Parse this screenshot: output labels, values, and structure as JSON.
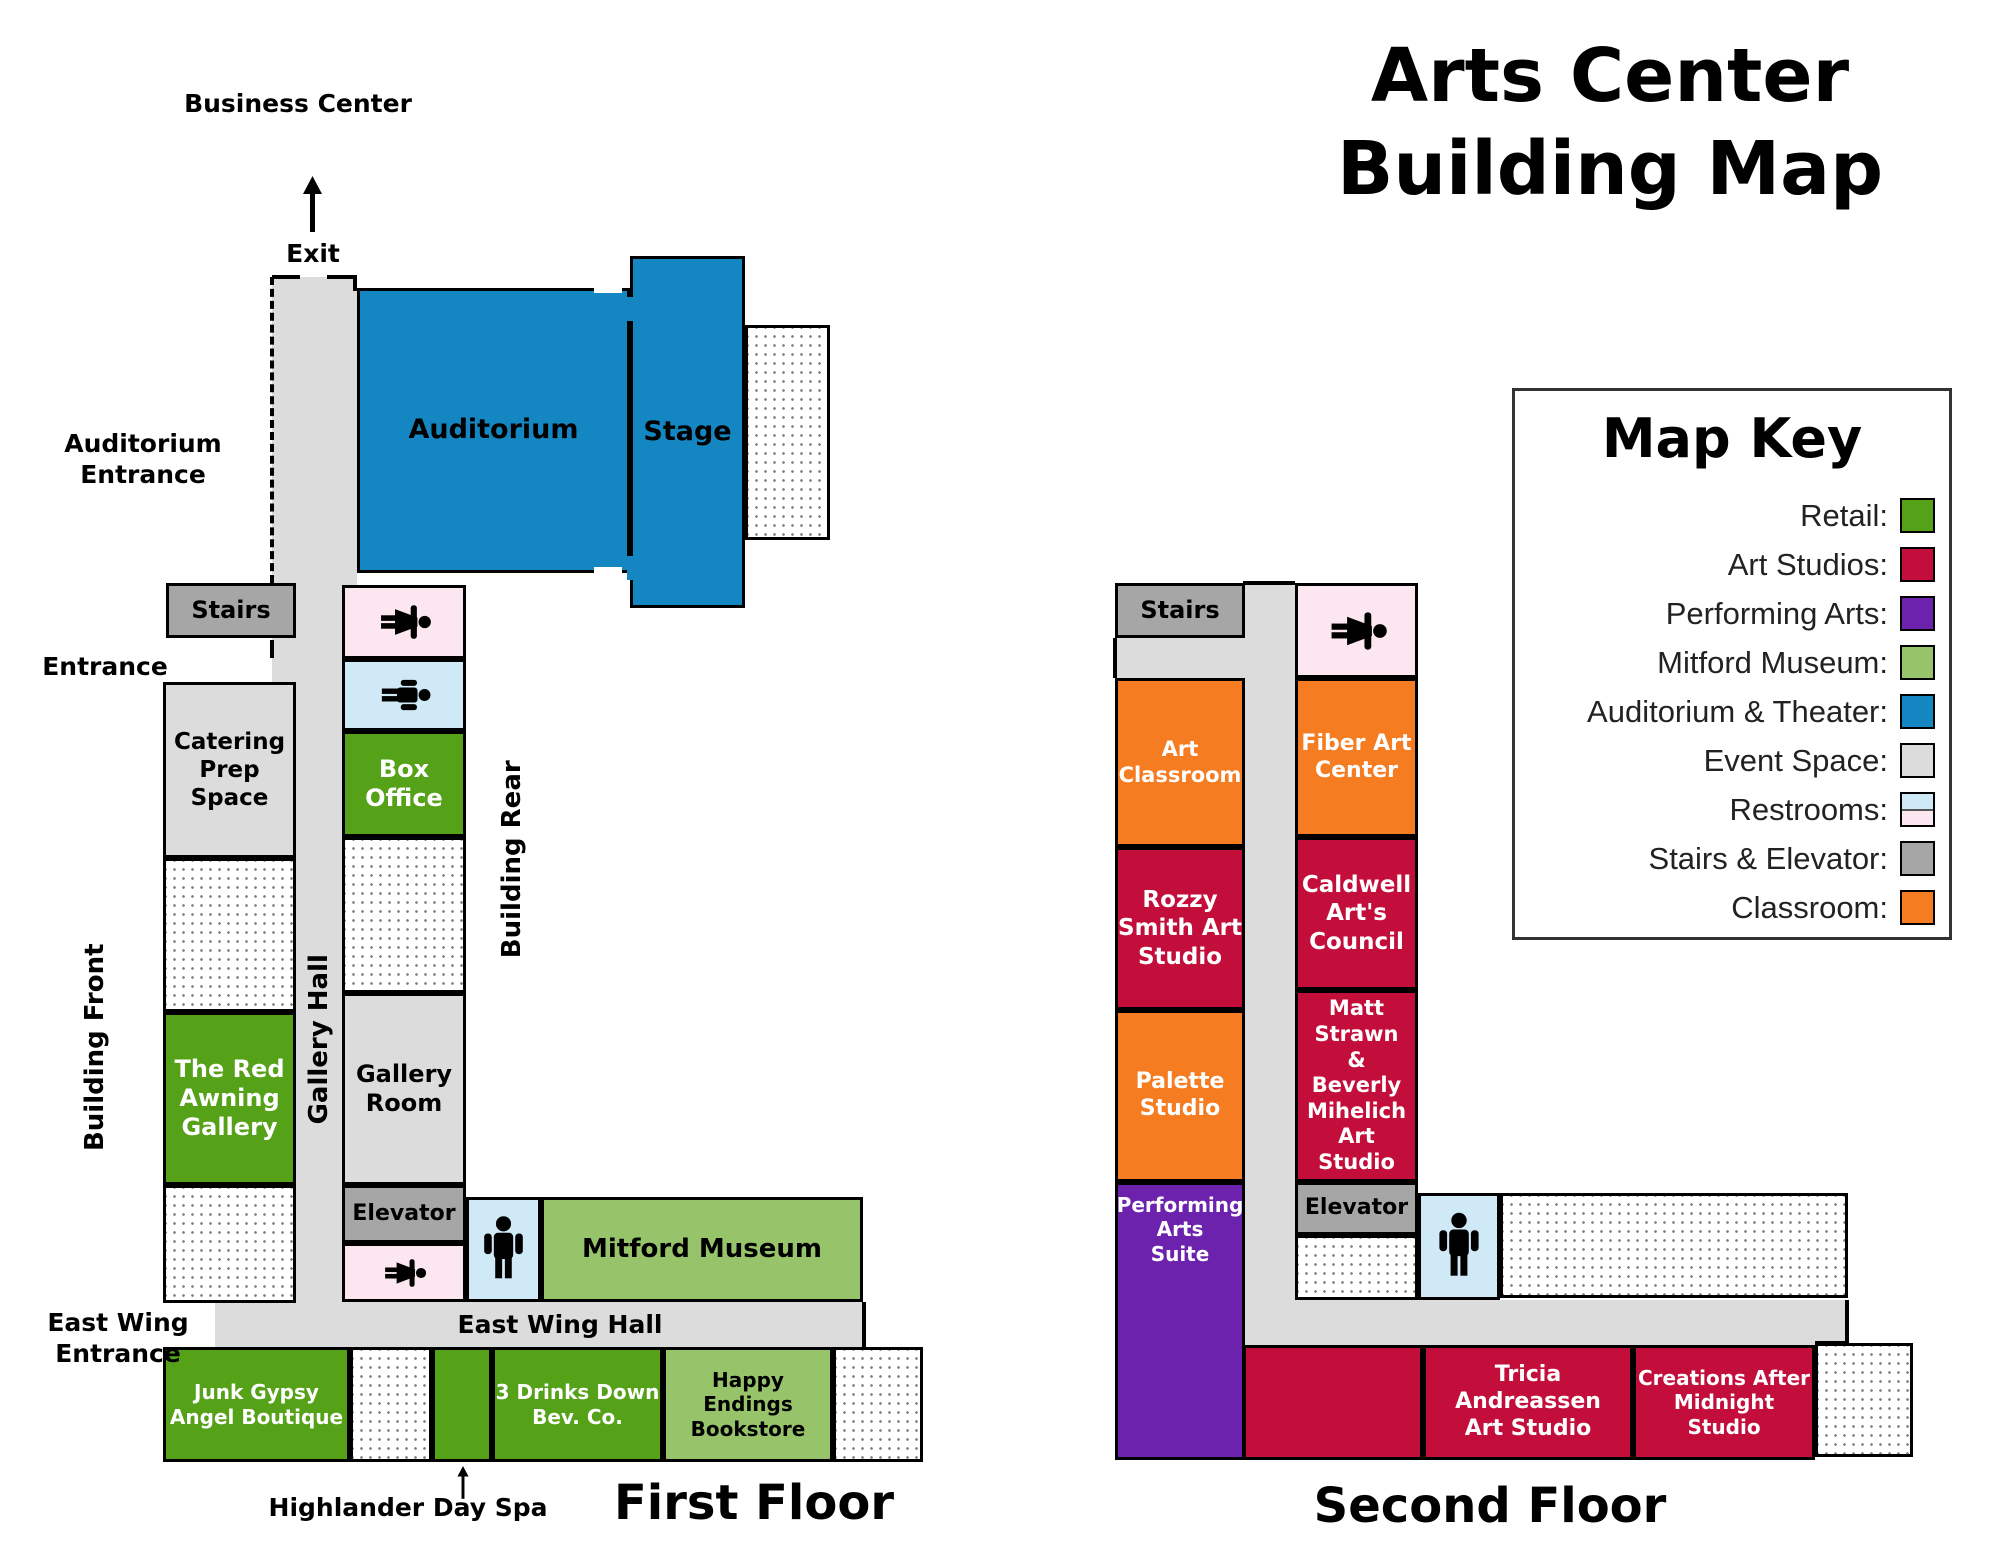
{
  "title": "Arts Center\nBuilding Map",
  "palette": {
    "retail": "#55a118",
    "art_studio": "#c30e3c",
    "performing": "#6c22ad",
    "museum": "#97c46a",
    "theater": "#1487c2",
    "event": "#dcdcdc",
    "restroom_f": "#fce7f0",
    "restroom_m": "#cfe9f7",
    "stairs": "#a6a6a6",
    "classroom": "#f57c20",
    "corridor": "#dcdcdc"
  },
  "map_key": {
    "title": "Map Key",
    "items": [
      {
        "label": "Retail:",
        "color": "#55a118"
      },
      {
        "label": "Art Studios:",
        "color": "#c30e3c"
      },
      {
        "label": "Performing Arts:",
        "color": "#6c22ad"
      },
      {
        "label": "Mitford Museum:",
        "color": "#97c46a"
      },
      {
        "label": "Auditorium & Theater:",
        "color": "#1487c2"
      },
      {
        "label": "Event Space:",
        "color": "#dcdcdc"
      },
      {
        "label": "Restrooms:",
        "color": "#cfe9f7",
        "color2": "#fce7f0"
      },
      {
        "label": "Stairs & Elevator:",
        "color": "#a6a6a6"
      },
      {
        "label": "Classroom:",
        "color": "#f57c20"
      }
    ]
  },
  "first_floor": {
    "title": "First Floor",
    "rooms": {
      "auditorium": "Auditorium",
      "stage": "Stage",
      "stairs": "Stairs",
      "catering": "Catering\nPrep\nSpace",
      "box_office": "Box\nOffice",
      "red_awning": "The Red\nAwning\nGallery",
      "gallery_room": "Gallery\nRoom",
      "elevator": "Elevator",
      "mitford_museum": "Mitford Museum",
      "junk_gypsy": "Junk Gypsy\nAngel Boutique",
      "three_drinks": "3 Drinks Down\nBev. Co.",
      "happy_endings": "Happy Endings\nBookstore"
    },
    "labels": {
      "business_center": "Business Center",
      "exit": "Exit",
      "auditorium_entrance": "Auditorium\nEntrance",
      "entrance": "Entrance",
      "building_front": "Building Front",
      "gallery_hall": "Gallery Hall",
      "building_rear": "Building Rear",
      "east_wing_entrance": "East Wing\nEntrance",
      "east_wing_hall": "East Wing Hall",
      "highlander_day_spa": "Highlander Day Spa"
    }
  },
  "second_floor": {
    "title": "Second Floor",
    "rooms": {
      "stairs": "Stairs",
      "art_classroom": "Art\nClassroom",
      "fiber_art": "Fiber Art\nCenter",
      "rozzy": "Rozzy\nSmith Art\nStudio",
      "caldwell": "Caldwell\nArt's\nCouncil",
      "palette_studio": "Palette\nStudio",
      "matt_strawn": "Matt\nStrawn\n&\nBeverly\nMihelich\nArt Studio",
      "performing_arts": "Performing\nArts\nSuite",
      "elevator": "Elevator",
      "tricia": "Tricia\nAndreassen\nArt Studio",
      "creations": "Creations After\nMidnight\nStudio"
    }
  },
  "icons": {
    "woman_restroom": "woman-icon",
    "man_restroom": "man-icon",
    "exit_arrow": "up-arrow-icon",
    "spa_arrow": "up-arrow-icon"
  }
}
